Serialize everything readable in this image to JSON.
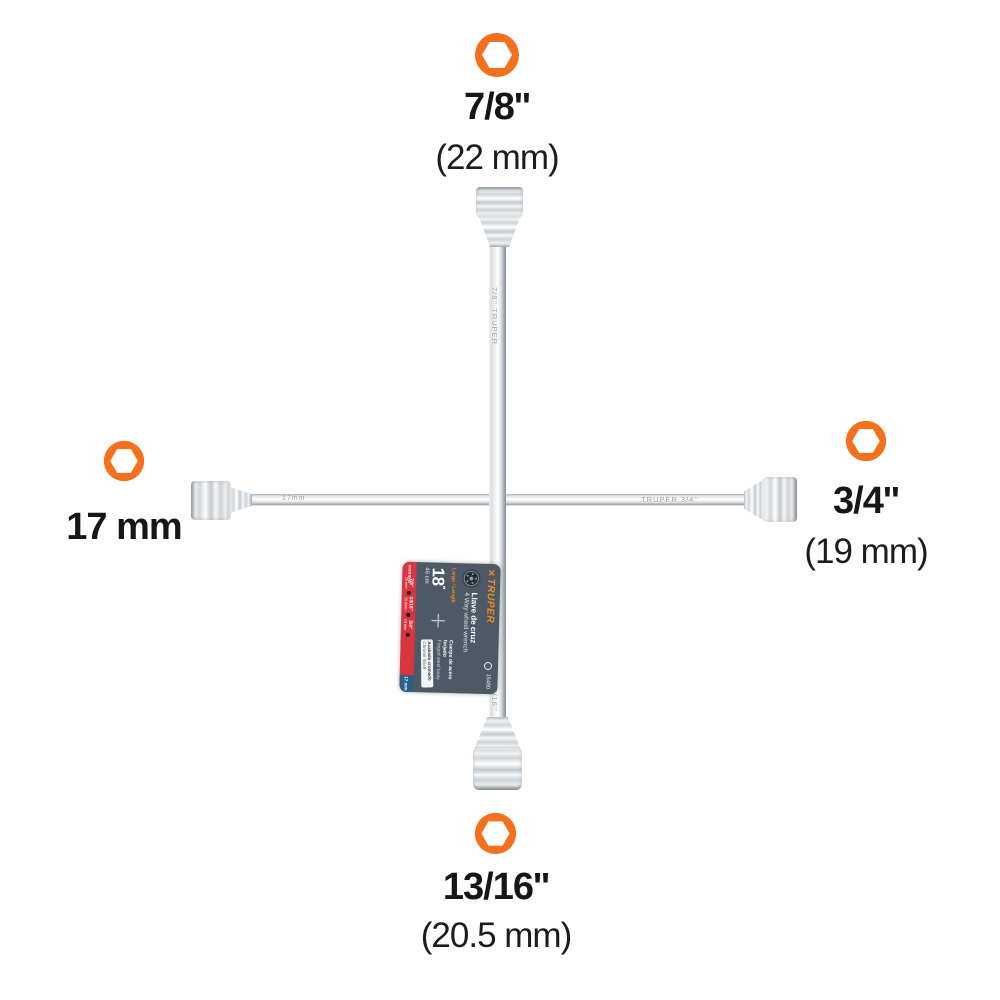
{
  "colors": {
    "hex_icon": "#f4701d",
    "tag_bg": "#4d5a66",
    "tag_red": "#d8353f",
    "tag_blue": "#2d5e86",
    "truper_orange": "#f68b1f"
  },
  "callouts": {
    "top": {
      "size": "7/8''",
      "metric": "(22 mm)"
    },
    "right": {
      "size": "3/4''",
      "metric": "(19 mm)"
    },
    "left": {
      "size": "17 mm",
      "metric": ""
    },
    "bottom": {
      "size": "13/16''",
      "metric": "(20.5 mm)"
    }
  },
  "engravings": {
    "left_arm": "17mm",
    "right_arm": "TRUPER   3/4''",
    "top_arm": "7/8''   TRUPER",
    "bottom_arm": "13/16''"
  },
  "tag": {
    "brand": "TRUPER",
    "code": "15480",
    "product_name_es": "Llave de cruz",
    "product_name_en": "4 Way wheel wrench",
    "length_label": "Largo / Length",
    "length_value": "18",
    "length_unit": "''",
    "length_metric": "46 cm",
    "body_es": "Cuerpo de acero forjado",
    "body_en": "Forged steel body",
    "finish_es": "Acabado cromado",
    "finish_en": "Chrome finish",
    "contains_label": "CONTIENE",
    "sizes": [
      {
        "in": "7/8''",
        "mm": "22 mm"
      },
      {
        "in": "13/16''",
        "mm": "20.5mm"
      },
      {
        "in": "3/4''",
        "mm": "19 mm"
      }
    ],
    "size_metric_only": "17 mm"
  }
}
